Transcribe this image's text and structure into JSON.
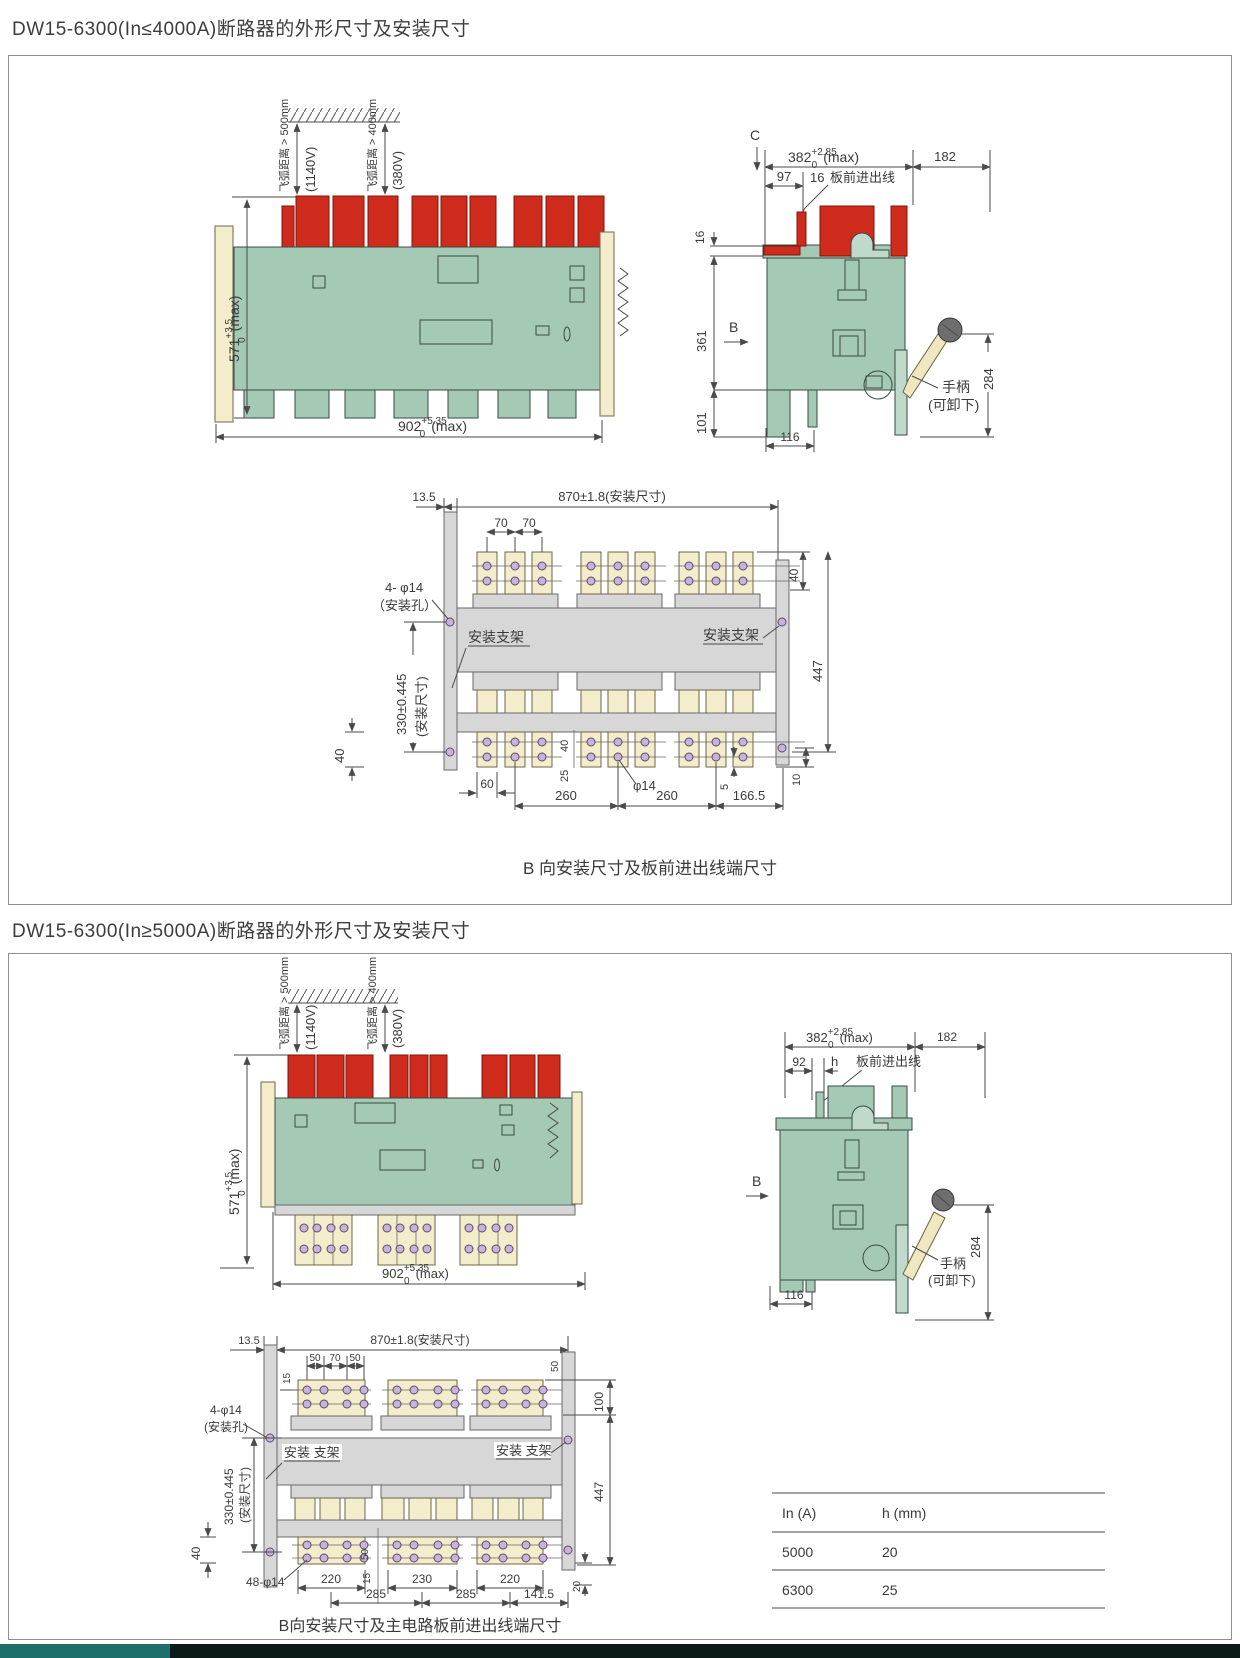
{
  "sections": [
    {
      "title": "DW15-6300(In≤4000A)断路器的外形尺寸及安装尺寸",
      "front": {
        "arc1": "飞弧距离 > 500mm",
        "arc1v": "(1140V)",
        "arc2": "飞弧距离 > 400mm",
        "arc2v": "(380V)",
        "h": "571",
        "htp": "+3.5",
        "htb": "0",
        "hmax": "(max)",
        "w": "902",
        "wtp": "+5.35",
        "wtb": "0",
        "wmax": "(max)"
      },
      "side": {
        "c": "C",
        "b": "B",
        "d382": "382",
        "tp": "+2.85",
        "tb": "0",
        "max": "(max)",
        "d182": "182",
        "d97": "97",
        "d16a": "16",
        "lead": "板前进出线",
        "d16b": "16",
        "d361": "361",
        "d101": "101",
        "d116": "116",
        "d284": "284",
        "handle1": "手柄",
        "handle2": "(可卸下)"
      },
      "bview": {
        "d135": "13.5",
        "d870": "870±1.8(安装尺寸)",
        "d70a": "70",
        "d70b": "70",
        "holes": "4- φ14",
        "holes2": "（安装孔）",
        "brL": "安装支架",
        "brR": "安装支架",
        "d330": "330±0.445",
        "d330b": "(安装尺寸)",
        "d40l": "40",
        "d60": "60",
        "d40m": "40",
        "d25": "25",
        "phi": "φ14",
        "d5": "5",
        "d260a": "260",
        "d260b": "260",
        "d1665": "166.5",
        "d40r": "40",
        "d447": "447",
        "d10": "10"
      },
      "caption": "B 向安装尺寸及板前进出线端尺寸"
    },
    {
      "title": "DW15-6300(In≥5000A)断路器的外形尺寸及安装尺寸",
      "front": {
        "arc1": "飞弧距离 > 500mm",
        "arc1v": "(1140V)",
        "arc2": "飞弧距离 > 400mm",
        "arc2v": "(380V)",
        "h": "571",
        "htp": "+3.5",
        "htb": "0",
        "hmax": "(max)",
        "w": "902",
        "wtp": "+5.35",
        "wtb": "0",
        "wmax": "(max)"
      },
      "side": {
        "b": "B",
        "d382": "382",
        "tp": "+2.85",
        "tb": "0",
        "max": "(max)",
        "d182": "182",
        "d92": "92",
        "dh": "h",
        "lead": "板前进出线",
        "d116": "116",
        "d284": "284",
        "handle1": "手柄",
        "handle2": "(可卸下)"
      },
      "bview": {
        "d135": "13.5",
        "d870": "870±1.8(安装尺寸)",
        "d50a": "50",
        "d70": "70",
        "d50b": "50",
        "d15": "15",
        "d50r": "50",
        "holes": "4-φ14",
        "holes2": "(安装孔)",
        "brL": "安装 支架",
        "brR": "安装 支架",
        "d330": "330±0.445",
        "d330b": "(安装尺寸)",
        "d100": "100",
        "d40": "40",
        "d48": "48-φ14",
        "d220a": "220",
        "d50m": "50",
        "d15m": "15",
        "d230": "230",
        "d285a": "285",
        "d285b": "285",
        "d220b": "220",
        "d1415": "141.5",
        "d20": "20",
        "d447": "447"
      },
      "caption": "B向安装尺寸及主电路板前进出线端尺寸",
      "table": {
        "headers": [
          "In (A)",
          "h (mm)"
        ],
        "rows": [
          [
            "5000",
            "20"
          ],
          [
            "6300",
            "25"
          ]
        ]
      }
    }
  ]
}
